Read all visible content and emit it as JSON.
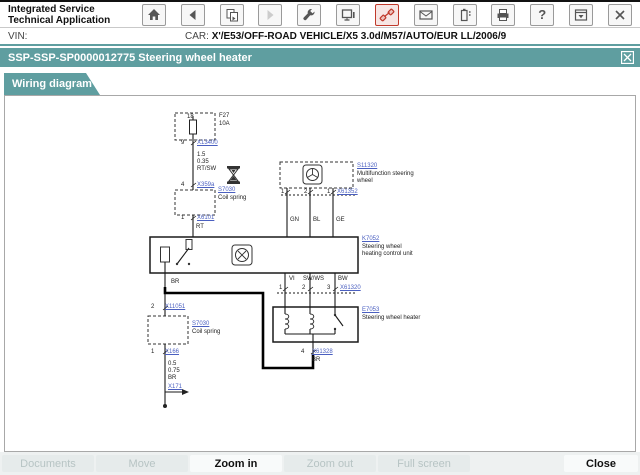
{
  "colors": {
    "teal": "#5f9ea0",
    "link_blue": "#4a5fc0",
    "highlight_red": "#c0392b"
  },
  "header": {
    "app_title_1": "Integrated Service",
    "app_title_2": "Technical Application",
    "vin_label": "VIN:",
    "car_label": "CAR:",
    "car_value": "X'/E53/OFF-ROAD VEHICLE/X5 3.0d/M57/AUTO/EUR LL/2006/9",
    "help_glyph": "?",
    "icons": [
      "home-icon",
      "back-icon",
      "copy-pages-icon",
      "forward-icon",
      "wrench-icon",
      "monitor-icon",
      "connector-icon",
      "mail-icon",
      "battery-icon",
      "printer-icon",
      "help-icon",
      "minimize-window-icon",
      "close-app-icon"
    ]
  },
  "title_bar": {
    "title": "SSP-SSP-SP0000012775 Steering wheel heater"
  },
  "tabs": [
    {
      "label": "Wiring diagram"
    }
  ],
  "diagram": {
    "pin_18": "18",
    "fuse_name": "F27",
    "fuse_rating": "10A",
    "c1_pin": "9",
    "c1_link": "X13400",
    "w1_1": "1.5",
    "w1_2": "0.35",
    "w1_3": "RT/SW",
    "c2_pin": "4",
    "c2_link": "X359a",
    "coil1_link": "S7030",
    "coil1_label": "Coil spring",
    "c3_pin": "1",
    "c3_link": "X6101",
    "c3_wire": "RT",
    "cu_link": "K7052",
    "cu_l1": "Steering wheel",
    "cu_l2": "heating control unit",
    "mf_link": "S11320",
    "mf_l1": "Multifunction steering",
    "mf_l2": "wheel",
    "mf_p1": "1",
    "mf_p2": "2",
    "mf_p3": "1",
    "mf_conn": "X61352",
    "wc1": "GN",
    "wc2": "BL",
    "wc3": "GE",
    "br_wire": "BR",
    "hw1": "VI",
    "hw2": "SW/WS",
    "hw3": "BW",
    "hp1": "1",
    "hp2": "2",
    "hp3": "3",
    "h_conn": "X61320",
    "ht_link": "E7053",
    "ht_label": "Steering wheel heater",
    "hb_pin": "4",
    "hb_link": "X61328",
    "hb_wire": "BR",
    "b_pin": "2",
    "b_link": "X11051",
    "coil2_link": "S7030",
    "coil2_label": "Coil spring",
    "g_pin": "1",
    "g_link": "X166",
    "g1": "0.5",
    "g2": "0.75",
    "g3": "BR",
    "g_link2": "X171"
  },
  "footer": {
    "buttons": [
      {
        "label": "Documents",
        "enabled": false
      },
      {
        "label": "Move",
        "enabled": false
      },
      {
        "label": "Zoom in",
        "enabled": true
      },
      {
        "label": "Zoom out",
        "enabled": false
      },
      {
        "label": "Full screen",
        "enabled": false
      },
      {
        "label": "Close",
        "enabled": true
      }
    ]
  }
}
